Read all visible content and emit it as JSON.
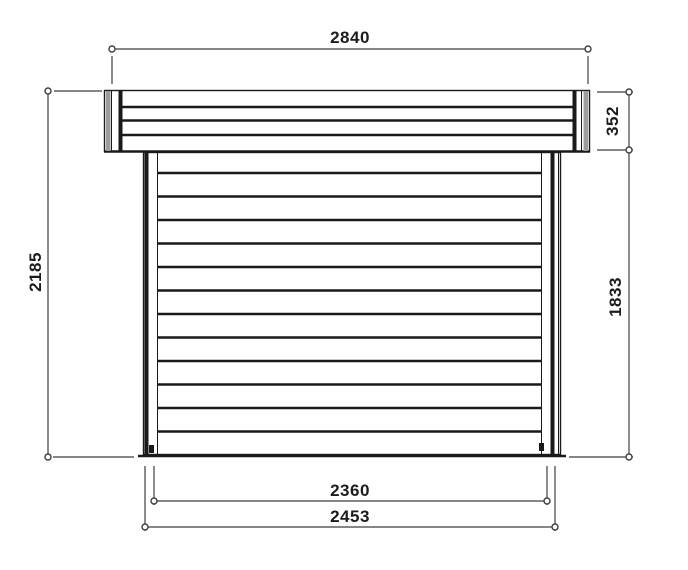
{
  "colors": {
    "background": "#ffffff",
    "object_line": "#1a1a1a",
    "dimension_line": "#3f3f3f",
    "fascia_shade": "#9c9c9c",
    "text": "#1c1c1c"
  },
  "dimensions": {
    "roof_width": "2840",
    "roof_thickness": "352",
    "overall_height": "2185",
    "wall_height": "1833",
    "wall_width_inner": "2360",
    "wall_width_outer": "2453"
  }
}
